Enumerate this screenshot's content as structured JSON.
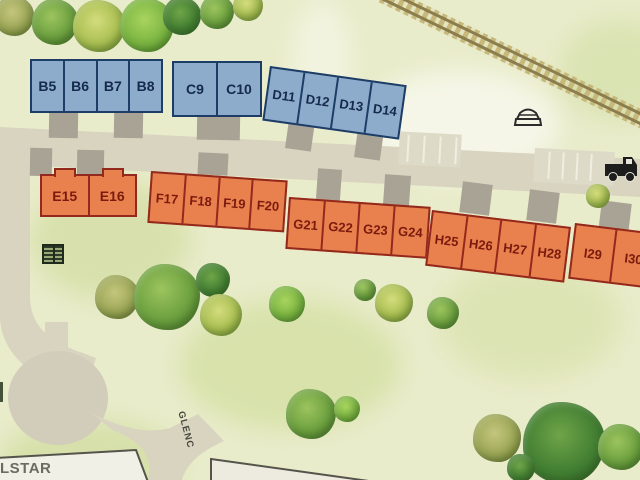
{
  "watermark": {
    "text": "LSTAR"
  },
  "road": {
    "label": "GLENC"
  },
  "blocks": [
    {
      "id": "B",
      "category": "blue",
      "units": [
        "B5",
        "B6",
        "B7",
        "B8"
      ]
    },
    {
      "id": "C",
      "category": "blue",
      "units": [
        "C9",
        "C10"
      ]
    },
    {
      "id": "D",
      "category": "blue",
      "units": [
        "D11",
        "D12",
        "D13",
        "D14"
      ]
    },
    {
      "id": "E",
      "category": "orange",
      "units": [
        "E15",
        "E16"
      ]
    },
    {
      "id": "F",
      "category": "orange",
      "units": [
        "F17",
        "F18",
        "F19",
        "F20"
      ]
    },
    {
      "id": "G",
      "category": "orange",
      "units": [
        "G21",
        "G22",
        "G23",
        "G24"
      ]
    },
    {
      "id": "H",
      "category": "orange",
      "units": [
        "H25",
        "H26",
        "H27",
        "H28"
      ]
    },
    {
      "id": "I",
      "category": "orange",
      "units": [
        "I29",
        "I30"
      ]
    }
  ],
  "colors": {
    "background": "#e9ecca",
    "road": "#d8d4c0",
    "blue_fill": "#8dabca",
    "blue_border": "#1d3d66",
    "blue_text": "#14294e",
    "orange_fill": "#e8814e",
    "orange_border": "#93291c",
    "orange_text": "#7c1a0e",
    "railroad_tie": "#c7b87c",
    "railroad_rail": "#8b7d4c"
  },
  "icons": {
    "railroad": "railroad-track",
    "car_top": "car-icon",
    "truck": "truck-icon",
    "utility": "utility-structure-icon"
  }
}
